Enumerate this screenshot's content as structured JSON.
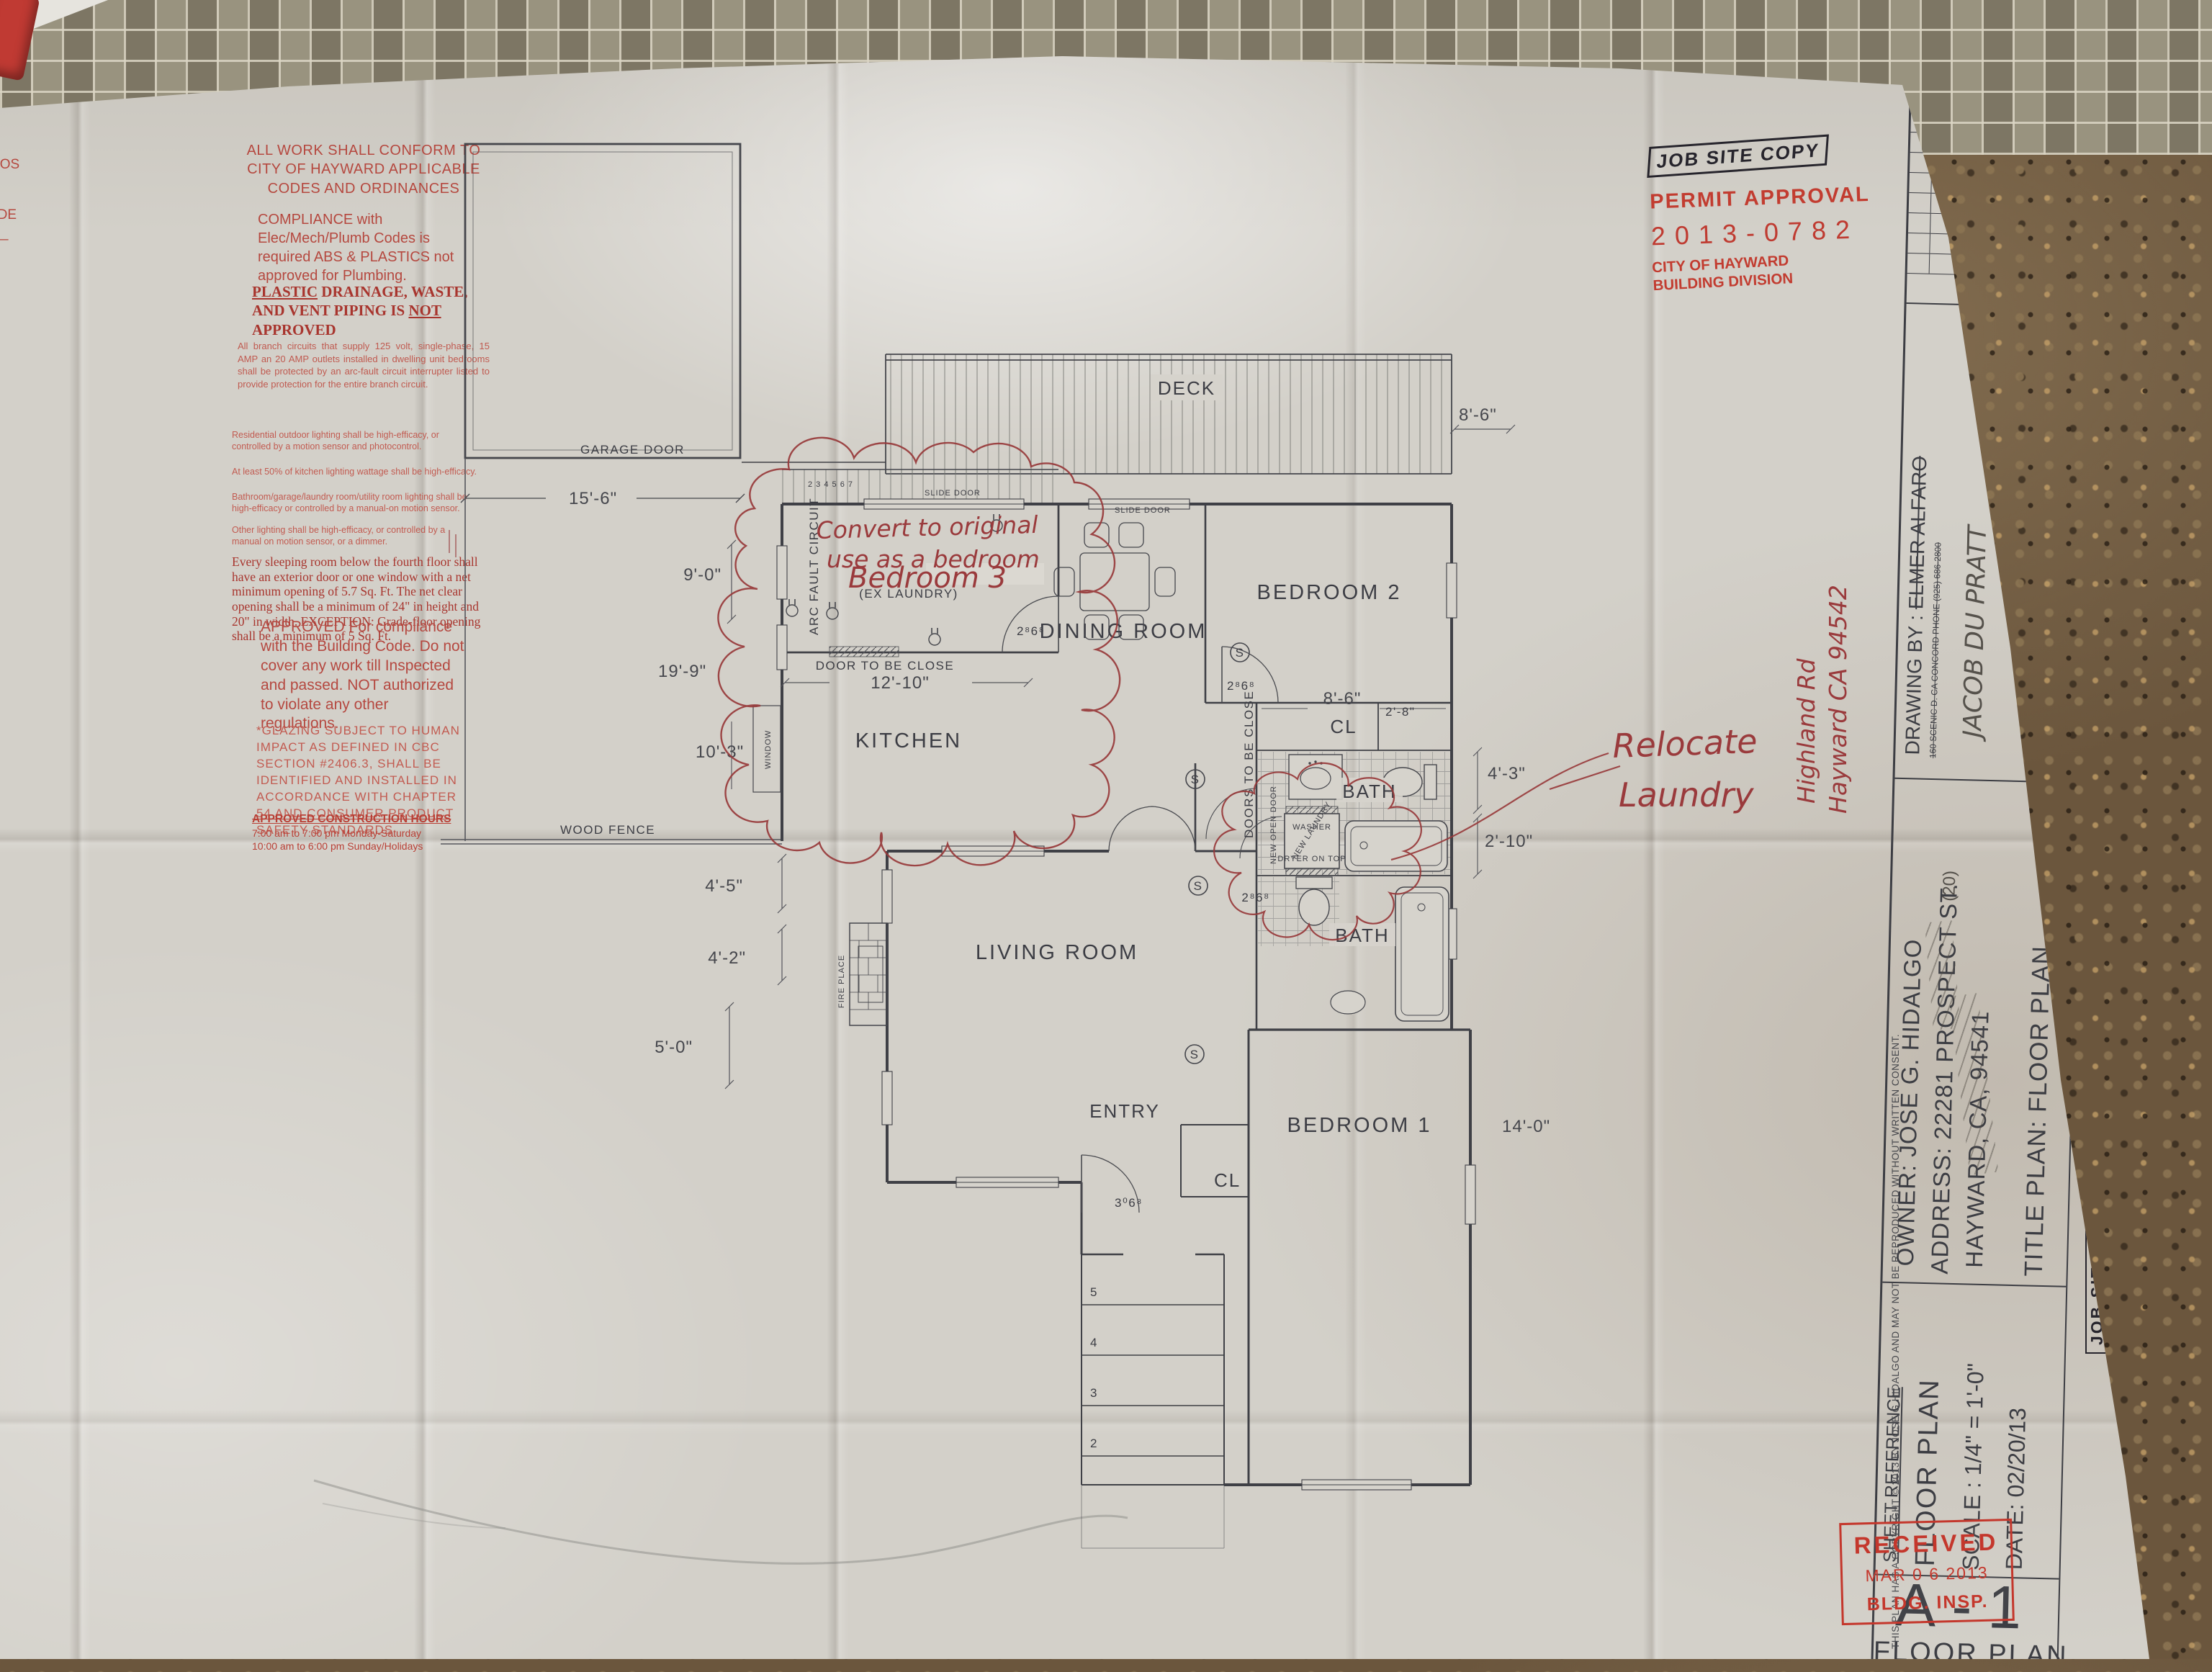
{
  "scene": {
    "description": "photo of folded blueprint floor plan on granite countertop with mosaic tile backsplash",
    "paper_color": "#d3d0c9",
    "granite_color": "#6b563d",
    "stamp_red": "#c23c30",
    "ink": "#3c3d44",
    "markup_red": "#97383a"
  },
  "notes_column": {
    "n1": "ALL WORK SHALL CONFORM TO CITY OF HAYWARD APPLICABLE CODES AND ORDINANCES",
    "n2": "COMPLIANCE with Elec/Mech/Plumb Codes is required ABS & PLASTICS not approved for Plumbing.",
    "n3_w1": "PLASTIC",
    "n3_w2": " DRAINAGE, WASTE, AND VENT PIPING IS ",
    "n3_w3": "NOT",
    "n3_w4": " APPROVED",
    "n4": "All branch circuits that supply 125 volt, single-phase, 15 AMP an 20 AMP outlets installed in dwelling unit bedrooms shall be protected by an arc-fault circuit interrupter listed to provide protection for the entire branch circuit.",
    "n5": "Residential outdoor lighting shall be high-efficacy, or controlled by a motion sensor and photocontrol.",
    "n6": "At least 50% of kitchen lighting wattage shall be high-efficacy.",
    "n7": "Bathroom/garage/laundry room/utility room lighting shall be high-efficacy or controlled by a manual-on motion sensor.",
    "n8": "Other lighting shall be high-efficacy, or controlled by a manual on motion sensor, or a dimmer.",
    "n9": "Every sleeping room below the fourth floor shall have an exterior door or one window with a net minimum opening of 5.7 Sq. Ft. The net clear opening shall be a minimum of 24\" in height and 20\" in width. EXCEPTION: Grade-floor opening shall be a minimum of 5 Sq. Ft.",
    "n10": "APPROVED For compliance with the Building Code. Do not cover any work till Inspected and passed. NOT authorized to violate any other regulations.",
    "n11": "*GLAZING SUBJECT TO HUMAN IMPACT AS DEFINED IN CBC SECTION #2406.3, SHALL BE IDENTIFIED AND INSTALLED IN ACCORDANCE WITH CHAPTER 54 AND CONSUMER PRODUCT SAFETY STANDARDS",
    "n12_title": "APPROVED CONSTRUCTION HOURS",
    "n12_l1": "7:00 am to 7:00 pm Monday-Saturday",
    "n12_l2": "10:00 am to 6:00 pm Sunday/Holidays",
    "frag1": "ROS",
    "frag2": "ADE",
    "frag3": "L—"
  },
  "stamps": {
    "job_site_copy": "JOB SITE COPY",
    "permit_approval": "PERMIT APPROVAL",
    "permit_no": "2013-0782",
    "agency1": "CITY OF HAYWARD",
    "agency2": "BUILDING DIVISION",
    "received": "RECEIVED",
    "received_date": "MAR 0 6 2013",
    "received_dept": "BLDG. INSP."
  },
  "title_block": {
    "revisions_h": "REVISIONS",
    "by_h": "BY",
    "drawing_by_label": "DRAWING BY :",
    "drawing_by_name": "ELMER ALFARO",
    "drawing_by_addr": "160 SCENIC D. CA CONCORD  PHONE (925) 686-2800",
    "hand_drafter": "JACOB DU PRATT",
    "hand_sig": "(W SIGNATURE)",
    "owner": "OWNER: JOSE G. HIDALGO",
    "address": "ADDRESS: 22281 PROSPECT ST.",
    "addr_note": "(20)",
    "city": "HAYWARD, CA, 94541",
    "plan_title": "TITLE PLAN: FLOOR PLAN",
    "sheet_ref": "SHEET REFERENCE",
    "sheet_name": "FLOOR PLAN",
    "scale": "SCALE : 1/4\" = 1'-0\"",
    "date": "DATE: 02/20/13",
    "sheet_no": "A-1",
    "sheet_label": "FLOOR PLAN",
    "copyright": "THIS PLAN HAS A COPYRIGHT © 2013 BY JOSE G HIDALGO AND MAY NOT BE REPRODUCED WITHOUT WRITTEN CONSENT."
  },
  "annotations": {
    "convert1": "Convert to original",
    "convert2": "use as a bedroom",
    "bedroom3": "Bedroom 3",
    "relocate1": "Relocate",
    "relocate2": "Laundry",
    "side1": "Highland Rd",
    "side2": "Hayward CA 94542"
  },
  "plan": {
    "rooms": {
      "garage_door": "GARAGE DOOR",
      "deck": "DECK",
      "dining": "DINING ROOM",
      "bedroom2": "BEDROOM 2",
      "bedroom1": "BEDROOM 1",
      "living": "LIVING ROOM",
      "entry": "ENTRY",
      "kitchen": "KITCHEN",
      "cl": "CL",
      "bath": "BATH",
      "ex_laundry": "(EX LAUNDRY)"
    },
    "labels": {
      "slide_door": "SLIDE DOOR",
      "wood_fence": "WOOD FENCE",
      "door_close": "DOOR TO BE CLOSE",
      "doors_close": "DOORS TO BE CLOSE",
      "new_open_door": "NEW OPEN DOOR",
      "new_laundry": "NEW LAUNDRY",
      "washer": "WASHER",
      "dryer": "DRYER ON TOP",
      "arc_fault": "ARC FAULT CIRCUIT",
      "fireplace": "FIRE PLACE",
      "window": "WINDOW",
      "deck_steps": "2 3 4 5 6 7"
    },
    "symbols": {
      "smoke": "S"
    },
    "stairs": [
      "5",
      "4",
      "3",
      "2"
    ],
    "dims": {
      "d15_6": "15'-6\"",
      "d9_0": "9'-0\"",
      "d19_9": "19'-9\"",
      "d10_3": "10'-3\"",
      "d12_10": "12'-10\"",
      "d8_6": "8'-6\"",
      "d2_8": "2'-8\"",
      "d4_3": "4'-3\"",
      "d2_10": "2'-10\"",
      "d14_0": "14'-0\"",
      "d4_5": "4'-5\"",
      "d4_2": "4'-2\"",
      "d5_0": "5'-0\"",
      "door_2868": "2⁸6⁸",
      "door_3068": "3⁰6⁸"
    }
  }
}
